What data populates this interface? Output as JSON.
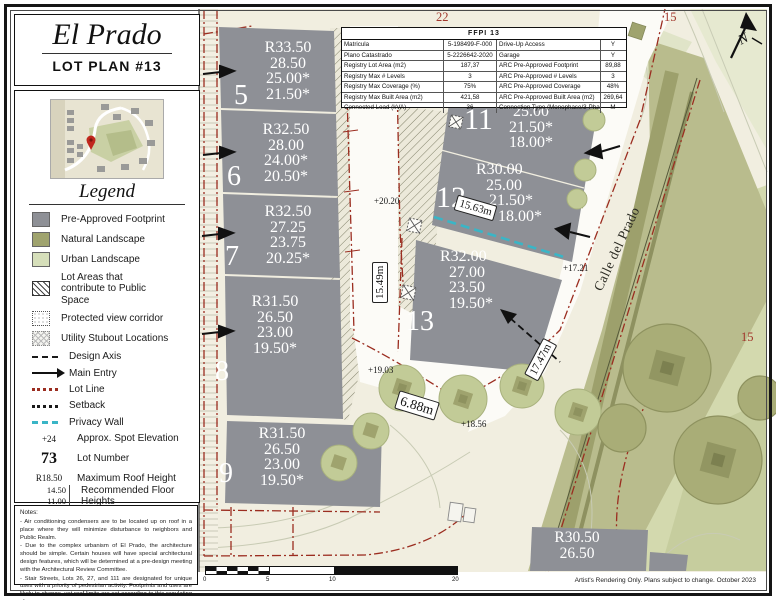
{
  "header": {
    "title": "El Prado",
    "subtitle": "LOT PLAN #13"
  },
  "legend": {
    "title": "Legend",
    "items": [
      {
        "icon": "footprint-swatch",
        "label": "Pre-Approved Footprint"
      },
      {
        "icon": "natural-swatch",
        "label": "Natural Landscape"
      },
      {
        "icon": "urban-swatch",
        "label": "Urban Landscape"
      },
      {
        "icon": "hatch-swatch",
        "label": "Lot Areas that contribute to Public Space"
      },
      {
        "icon": "view-corridor-swatch",
        "label": "Protected view corridor"
      },
      {
        "icon": "utility-stubout-swatch",
        "label": "Utility Stubout Locations"
      },
      {
        "icon": "design-axis-line",
        "label": "Design Axis"
      },
      {
        "icon": "main-entry-arrow",
        "label": "Main Entry"
      },
      {
        "icon": "lot-line",
        "label": "Lot Line"
      },
      {
        "icon": "setback-line",
        "label": "Setback"
      },
      {
        "icon": "privacy-wall-line",
        "label": "Privacy Wall"
      },
      {
        "icon": "text-sample",
        "text": "+24",
        "label": "Approx. Spot Elevation"
      },
      {
        "icon": "text-sample",
        "text": "73",
        "label": "Lot Number"
      },
      {
        "icon": "text-sample",
        "text": "R18.50",
        "label": "Maximum Roof Height"
      }
    ],
    "floor_heights": {
      "values": [
        "14.50",
        "11.00"
      ],
      "label": "Recommended Floor Heights"
    },
    "street_access": {
      "values": [
        "7.00",
        "5.00*"
      ],
      "label": "Level with Street Access"
    }
  },
  "notes": {
    "title": "Notes:",
    "paragraphs": [
      "- Air conditioning condensers are to be located up on roof in a place where they will minimize disturbance to neighbors and Public Realm.",
      "- Due to the complex urbanism of El Prado, the architecture should be simple. Certain houses will have special architectural design features, which will be determined at a pre-design meeting with the Architectural Review Committee.",
      "- Stair Streets, Lots 26, 27, and 111 are designated for unique uses with a priority of pedestrian activity. Footprints and uses are likely to change, yet roof limits are set according to this regulating plan."
    ]
  },
  "table": {
    "title": "FFPI 13",
    "rows": [
      {
        "l1": "Matricula",
        "v1": "5-198499-F-000",
        "l2": "Drive-Up Access",
        "v2": "Y"
      },
      {
        "l1": "Plano Catastrado",
        "v1": "5-2226642-2020",
        "l2": "Garage",
        "v2": "Y"
      },
      {
        "l1": "Registry Lot Area (m2)",
        "v1": "187,37",
        "l2": "ARC Pre-Approved Footprint",
        "v2": "89,88"
      },
      {
        "l1": "Registry Max # Levels",
        "v1": "3",
        "l2": "ARC Pre-Approved # Levels",
        "v2": "3"
      },
      {
        "l1": "Registry Max Coverage (%)",
        "v1": "75%",
        "l2": "ARC Pre-Approved Coverage",
        "v2": "48%"
      },
      {
        "l1": "Registry Max Built Area (m2)",
        "v1": "421,58",
        "l2": "ARC Pre-Approved Built Area (m2)",
        "v2": "269,64"
      },
      {
        "l1": "Connected Load (kVA)",
        "v1": "36",
        "l2": "Connection Type (Monophase/3-Phase)",
        "v2": "M"
      }
    ]
  },
  "map": {
    "grid": {
      "top_center": "22",
      "top_right": "15",
      "right_edge": "15"
    },
    "compass_n": "N",
    "street": "Calle del Prado",
    "lots": {
      "l5": {
        "num": "5",
        "v": [
          "R33.50",
          "28.50",
          "25.00*",
          "21.50*"
        ]
      },
      "l6": {
        "num": "6",
        "v": [
          "R32.50",
          "28.00",
          "24.00*",
          "20.50*"
        ]
      },
      "l7": {
        "num": "7",
        "v": [
          "R32.50",
          "27.25",
          "23.75",
          "20.25*"
        ]
      },
      "l8": {
        "num": "8",
        "v": [
          "R31.50",
          "26.50",
          "23.00",
          "19.50*"
        ]
      },
      "l9": {
        "num": "9",
        "v": [
          "R31.50",
          "26.50",
          "23.00",
          "19.50*"
        ]
      },
      "l11": {
        "num": "11",
        "v": [
          "25.00",
          "21.50*",
          "18.00*"
        ]
      },
      "l12": {
        "num": "12",
        "v": [
          "R30.00",
          "25.00",
          "21.50*",
          "18.00*"
        ]
      },
      "l13": {
        "num": "13",
        "v": [
          "R32.00",
          "27.00",
          "23.50",
          "19.50*"
        ]
      },
      "lse": {
        "v": [
          "R30.50",
          "26.50"
        ]
      }
    },
    "dims": {
      "d1": "15.63m",
      "d2": "15.49m",
      "d3": "17.47m",
      "d4": "6.88m"
    },
    "spots": {
      "s1": "+20.20",
      "s2": "+17.21",
      "s3": "+19.03",
      "s4": "+18.56"
    },
    "scale_ticks": [
      "0",
      "5",
      "10",
      "20"
    ],
    "footer": "Artist's Rendering Only. Plans subject to change. October 2023"
  },
  "colors": {
    "footprint_gray": "#8e9096",
    "natural_olive": "#9fa36e",
    "urban_green": "#d6dfba",
    "lot_line_red": "#9b2d20",
    "privacy_cyan": "#3ab5c6",
    "grid_label_red": "#a2372c",
    "map_cream": "#f1eee0"
  }
}
